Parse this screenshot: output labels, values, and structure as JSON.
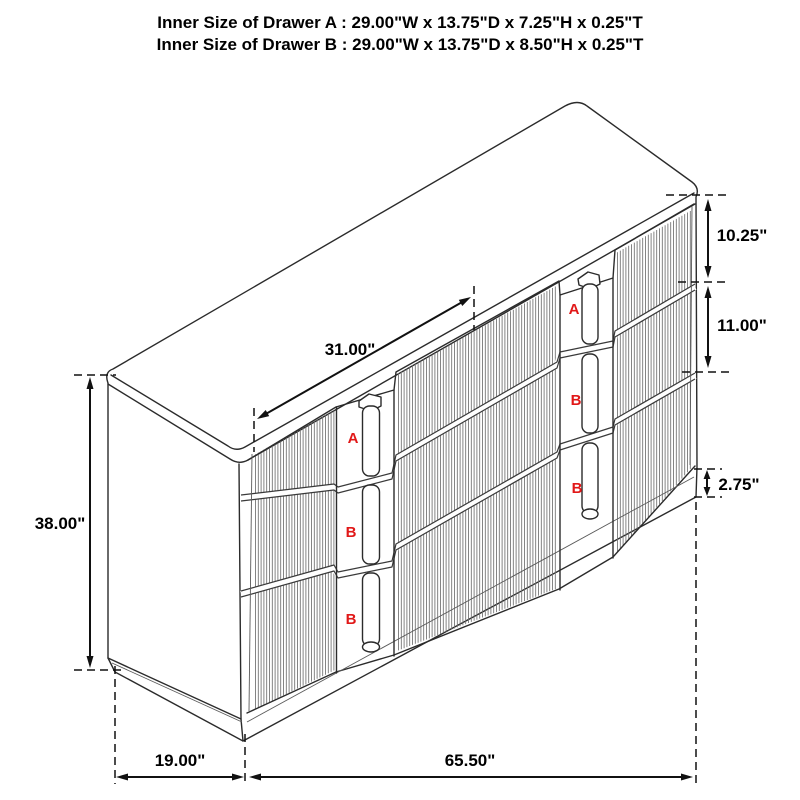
{
  "header": {
    "line1": "Inner Size of Drawer A : 29.00\"W x 13.75\"D x 7.25\"H x 0.25\"T",
    "line2": "Inner Size of Drawer B : 29.00\"W x 13.75\"D x 8.50\"H x 0.25\"T"
  },
  "dimensions": {
    "overall_height": "38.00\"",
    "top_surface_width": "31.00\"",
    "drawer_a_front_height": "10.25\"",
    "drawer_b_front_height": "11.00\"",
    "base_height": "2.75\"",
    "side_depth": "19.00\"",
    "overall_width": "65.50\""
  },
  "drawer_labels": {
    "left_column": [
      "A",
      "B",
      "B"
    ],
    "right_column": [
      "A",
      "B",
      "B"
    ]
  },
  "colors": {
    "line": "#2b2b2b",
    "flute": "#6f6f6f",
    "drawer_label": "#e11818",
    "text": "#000000",
    "background": "#ffffff"
  }
}
